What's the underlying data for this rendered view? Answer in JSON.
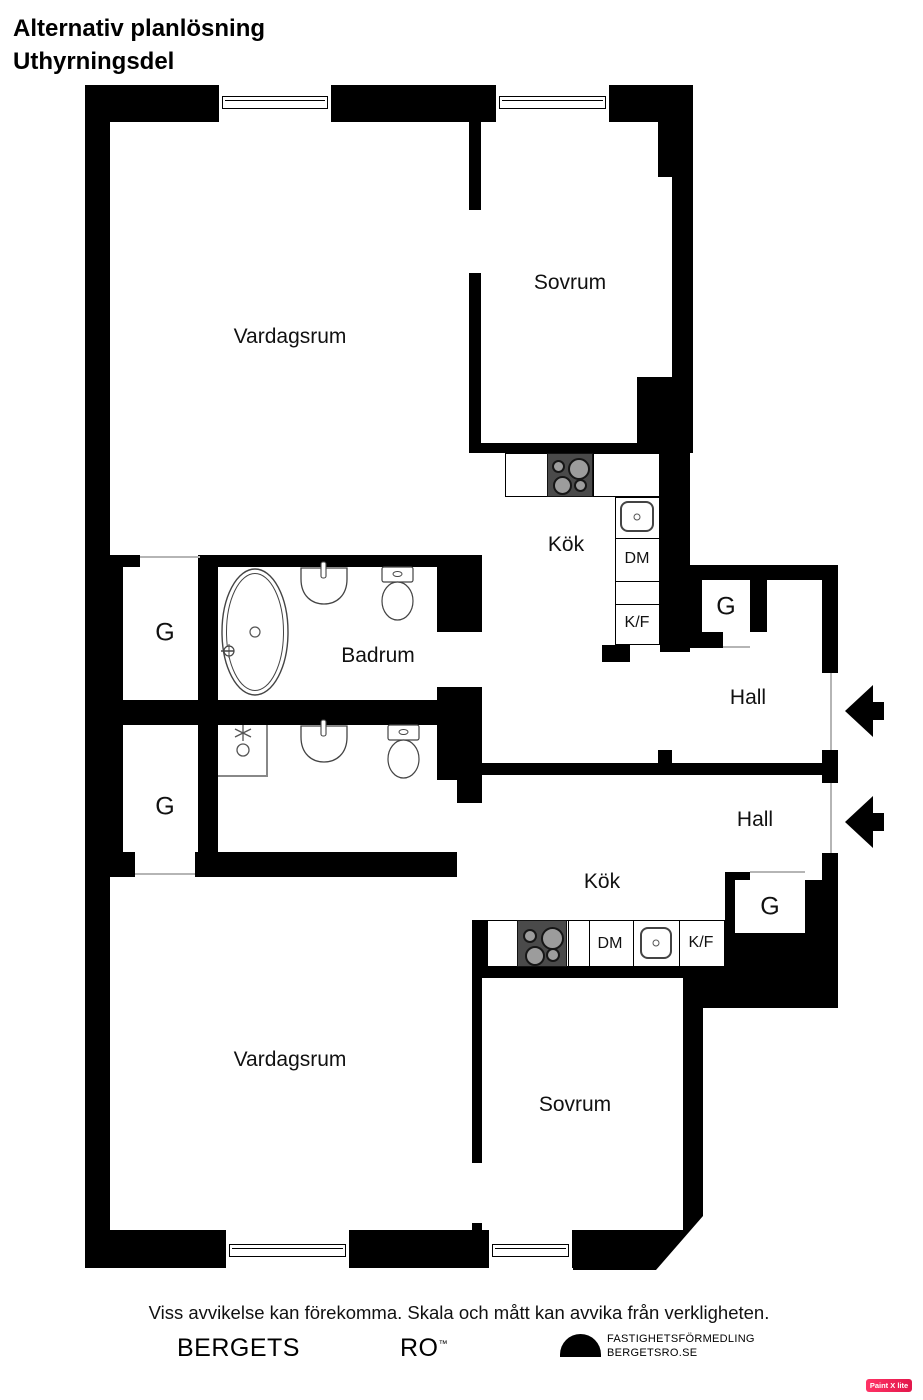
{
  "title": {
    "line1": "Alternativ planlösning",
    "line2": "Uthyrningsdel"
  },
  "rooms": {
    "vardagsrum_upper": "Vardagsrum",
    "sovrum_upper": "Sovrum",
    "kok_upper": "Kök",
    "badrum": "Badrum",
    "hall_upper": "Hall",
    "hall_lower": "Hall",
    "kok_lower": "Kök",
    "vardagsrum_lower": "Vardagsrum",
    "sovrum_lower": "Sovrum"
  },
  "closets": {
    "g1": "G",
    "g2": "G",
    "g3": "G",
    "g4": "G"
  },
  "appliances": {
    "dm_upper": "DM",
    "kf_upper": "K/F",
    "dm_lower": "DM",
    "kf_lower": "K/F"
  },
  "footer": {
    "disclaimer": "Viss avvikelse kan förekomma. Skala och mått kan avvika från verkligheten.",
    "brand_left": "BERGETS",
    "brand_right": "RO",
    "brand_tm": "™",
    "logo_line1": "FASTIGHETSFÖRMEDLING",
    "logo_line2": "BERGETSRO.SE"
  },
  "watermark": {
    "label": "Paint X lite",
    "color": "#e2174b"
  },
  "colors": {
    "wall": "#000000",
    "background": "#ffffff",
    "fixture_outline": "#444444",
    "stove": "#4a4a4a"
  }
}
